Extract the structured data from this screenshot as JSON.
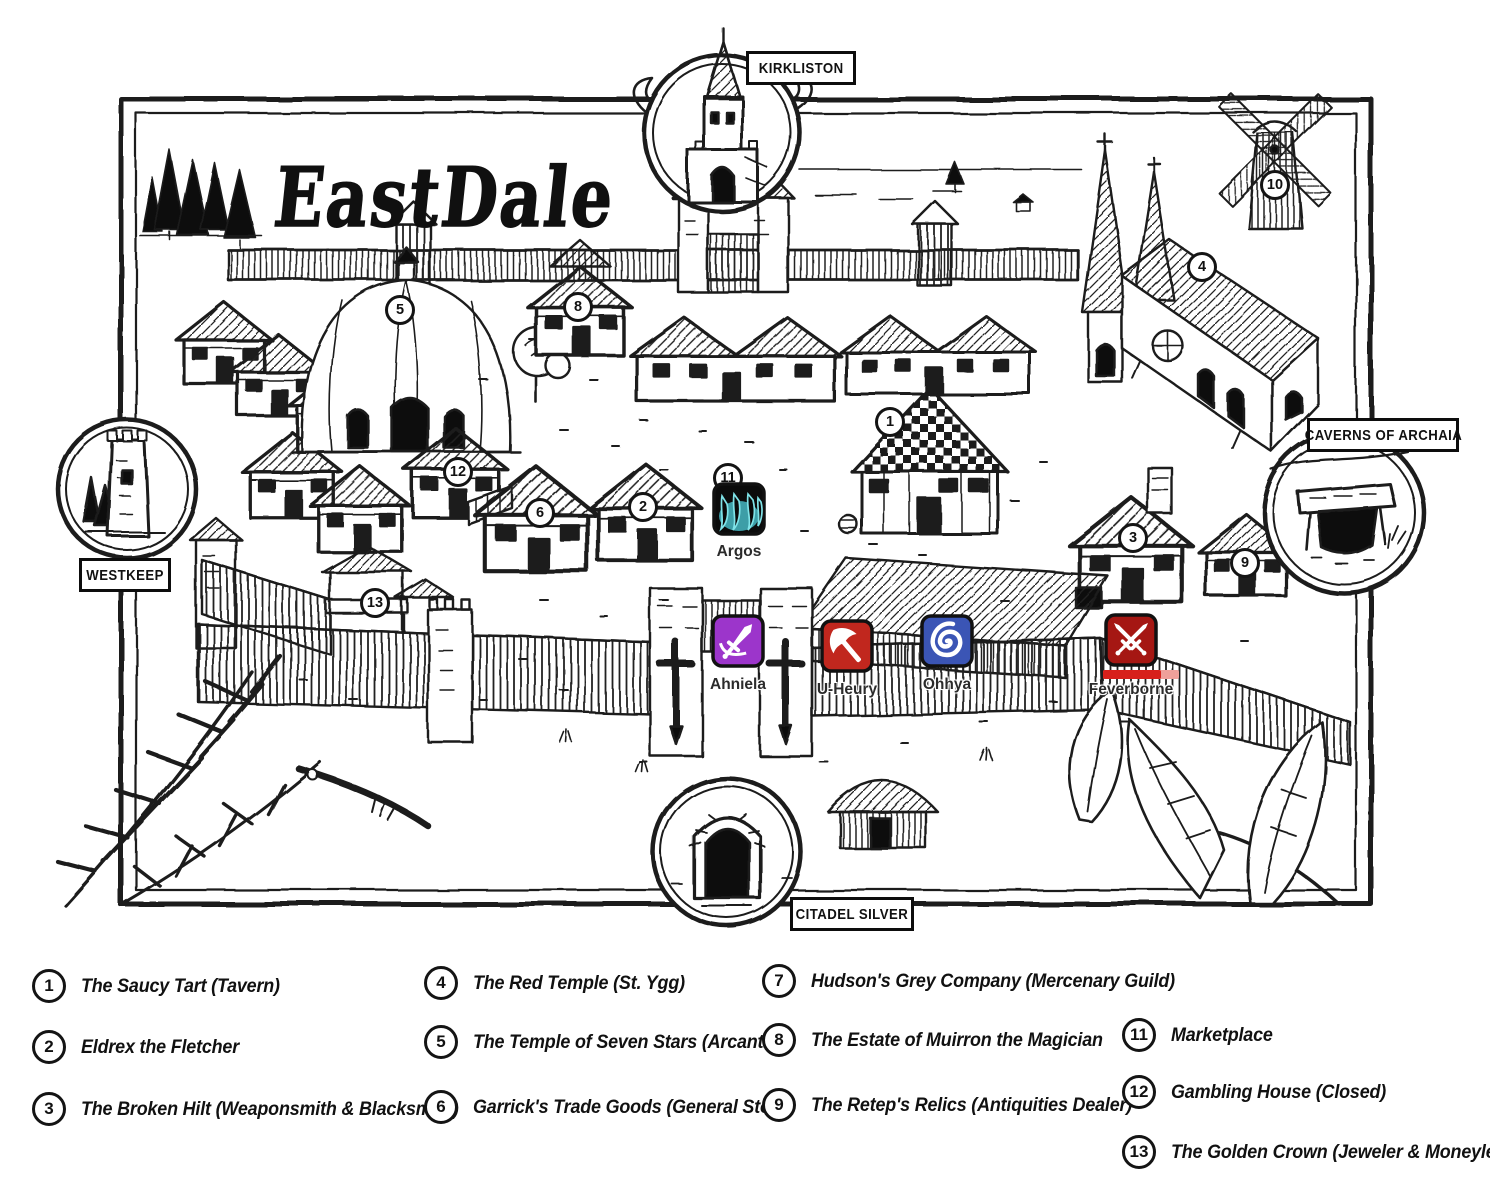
{
  "title": "EastDale",
  "exit_labels": {
    "north": "KIRKLISTON",
    "west": "WESTKEEP",
    "east": "CAVERNS OF ARCHAIA",
    "south": "CITADEL SILVER"
  },
  "markers": [
    {
      "num": "1"
    },
    {
      "num": "2"
    },
    {
      "num": "3"
    },
    {
      "num": "4"
    },
    {
      "num": "5"
    },
    {
      "num": "6"
    },
    {
      "num": "8"
    },
    {
      "num": "9"
    },
    {
      "num": "10"
    },
    {
      "num": "11"
    },
    {
      "num": "12"
    },
    {
      "num": "13"
    }
  ],
  "tokens": [
    {
      "name": "Argos",
      "icon": "claws",
      "bg": "#0b0b0b",
      "accent": "#7fe3e8",
      "glow": "#46b9c3"
    },
    {
      "name": "Ahniela",
      "icon": "dagger",
      "bg": "#9c35cb",
      "accent": "#ffffff"
    },
    {
      "name": "U-Heury",
      "icon": "battle-axe",
      "bg": "#c1271e",
      "accent": "#ffffff"
    },
    {
      "name": "Ohhya",
      "icon": "spiral",
      "bg": "#3b55b5",
      "accent": "#ffffff"
    },
    {
      "name": "Feverborne",
      "icon": "crossed-swords",
      "bg": "#a51713",
      "accent": "#ffffff",
      "health_fill": "#d7201b",
      "health_track": "#efa09a",
      "health_width": "58"
    }
  ],
  "legend": {
    "columns": [
      {
        "items": [
          {
            "num": "1",
            "label": "The Saucy Tart (Tavern)"
          },
          {
            "num": "2",
            "label": "Eldrex the Fletcher"
          },
          {
            "num": "3",
            "label": "The Broken Hilt (Weaponsmith & Blacksmith)"
          }
        ]
      },
      {
        "items": [
          {
            "num": "4",
            "label": "The Red Temple (St. Ygg)"
          },
          {
            "num": "5",
            "label": "The Temple of Seven Stars (Arcantryl)"
          },
          {
            "num": "6",
            "label": "Garrick's Trade Goods (General Store)"
          }
        ]
      },
      {
        "items": [
          {
            "num": "7",
            "label": "Hudson's Grey Company (Mercenary Guild)"
          },
          {
            "num": "8",
            "label": "The Estate of Muirron the Magician"
          },
          {
            "num": "9",
            "label": "The Retep's Relics (Antiquities Dealer)"
          }
        ]
      },
      {
        "items": [
          {
            "num": "11",
            "label": "Marketplace"
          },
          {
            "num": "12",
            "label": "Gambling House (Closed)"
          },
          {
            "num": "13",
            "label": "The Golden Crown (Jeweler & Moneylender)"
          }
        ]
      }
    ]
  }
}
